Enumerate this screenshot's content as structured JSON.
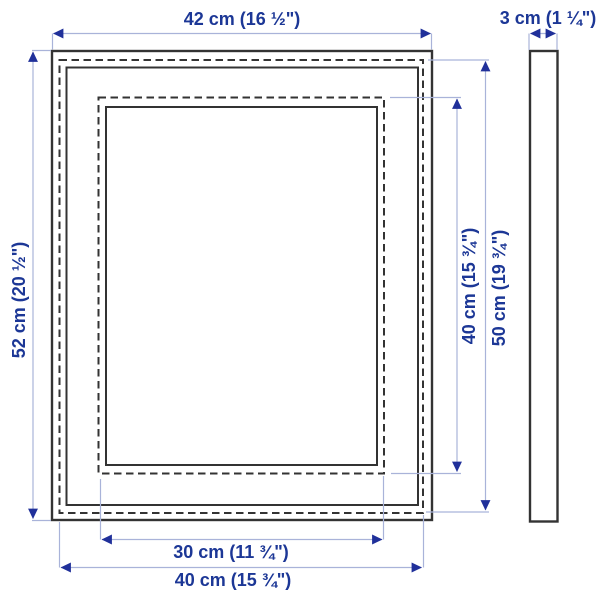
{
  "colors": {
    "background": "#ffffff",
    "frame_stroke": "#333333",
    "dim_line": "#a9b3d9",
    "dim_arrow": "#20309a",
    "dim_text": "#1c3796"
  },
  "dimensions": {
    "outer_width": "42 cm (16 ½\")",
    "depth": "3 cm (1 ¼\")",
    "outer_height": "52 cm (20 ½\")",
    "picture_height": "40 cm (15 ¾\")",
    "back_height": "50 cm (19 ¾\")",
    "picture_width": "30 cm (11 ¾\")",
    "back_width": "40 cm (15 ¾\")"
  }
}
